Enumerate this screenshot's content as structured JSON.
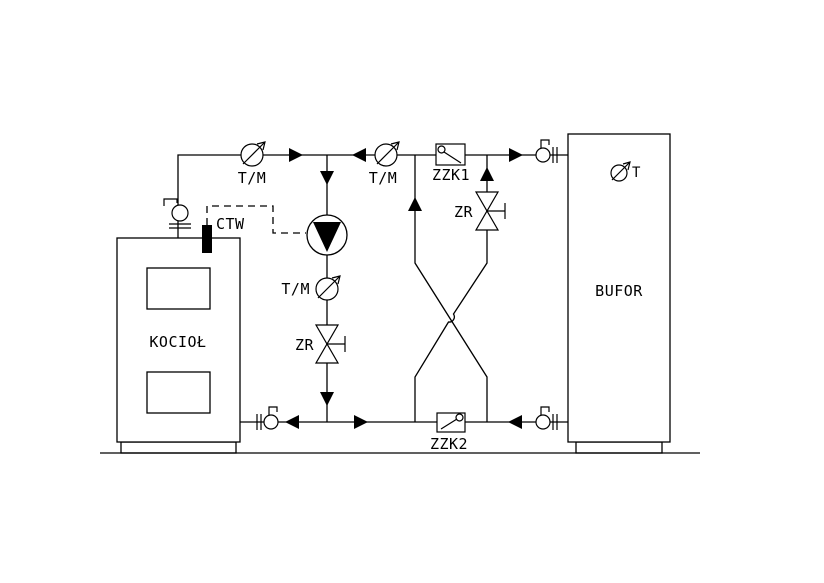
{
  "diagram": {
    "type": "heating-system-schematic",
    "colors": {
      "background": "#ffffff",
      "line": "#000000",
      "solid_fill": "#000000"
    },
    "labels": {
      "boiler": "KOCIOŁ",
      "buffer": "BUFOR",
      "buffer_temp_gauge": "T",
      "ctw_sensor": "CTW",
      "check_valve_supply": "ZZK1",
      "check_valve_return": "ZZK2",
      "regulating_valve_bypass": "ZR",
      "regulating_valve_pump": "ZR",
      "gauge_supply": "T/M",
      "gauge_bypass": "T/M",
      "gauge_pump": "T/M"
    },
    "icons": {
      "pump-icon": "circle with solid down triangle",
      "gauge-icon": "circle with diagonal arrow",
      "ball-valve-union-icon": "circle with lever and double bars",
      "gate-valve-icon": "bowtie with stem",
      "check-valve-icon": "box with pivot flap",
      "flow-arrow-icon": "solid triangle"
    }
  }
}
